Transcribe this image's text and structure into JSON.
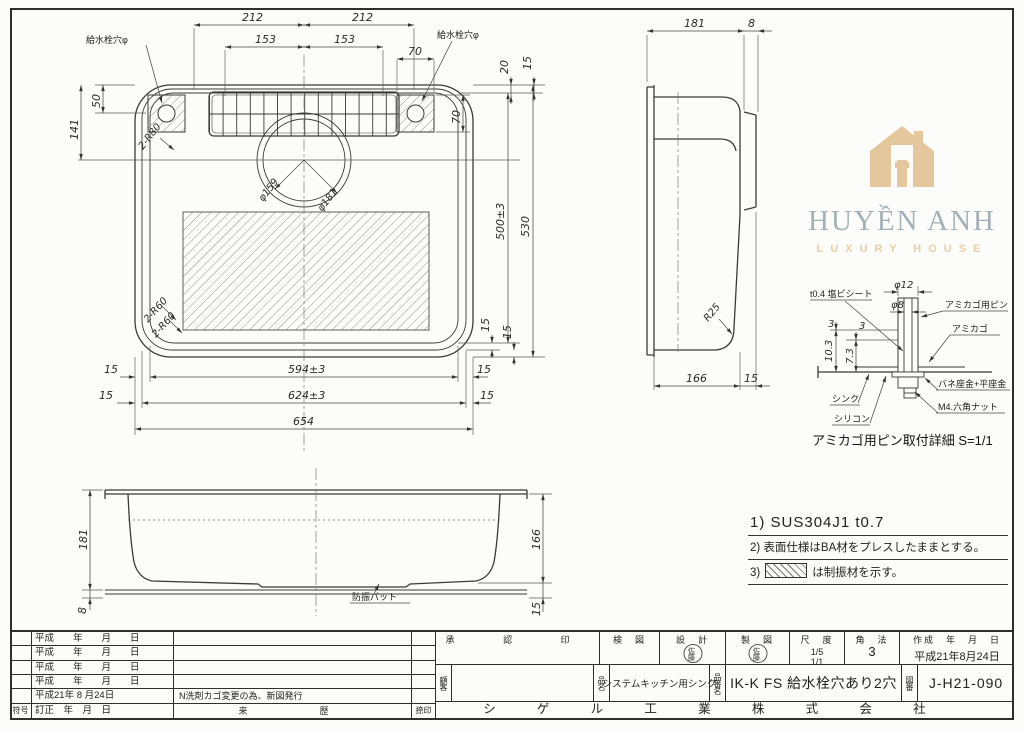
{
  "logo": {
    "title": "HUYỀN ANH",
    "subtitle": "LUXURY HOUSE",
    "title_color": "#a3b1b8",
    "accent_color": "#e4c79c"
  },
  "top_view": {
    "dims": {
      "d212l": "212",
      "d212r": "212",
      "d153l": "153",
      "d153r": "153",
      "d70top": "70",
      "d20": "20",
      "d15tr": "15",
      "d50": "50",
      "d141": "141",
      "d70r": "70",
      "r80": "2-R80",
      "r60a": "2-R60",
      "r60b": "2-R60",
      "dia159": "φ159",
      "dia181": "φ181",
      "d500": "500±3",
      "d530": "530",
      "d594": "594±3",
      "d624": "624±3",
      "d654": "654",
      "d15": "15"
    },
    "labels": {
      "faucet_left": "給水栓穴φ",
      "faucet_right": "給水栓穴φ"
    }
  },
  "side_view": {
    "dims": {
      "d181": "181",
      "d8": "8",
      "r25": "R25",
      "d166": "166",
      "d15": "15"
    }
  },
  "front_view": {
    "dims": {
      "d181": "181",
      "d8": "8",
      "d166": "166",
      "d15": "15"
    },
    "labels": {
      "pad": "防振パット"
    }
  },
  "detail_view": {
    "dims": {
      "dia12": "φ12",
      "dia8": "φ8",
      "d103": "10.3",
      "d73": "7.3",
      "d3a": "3",
      "d3b": "3"
    },
    "labels": {
      "sheet": "t0.4 塩ビシート",
      "pin": "アミカゴ用ピン",
      "basket": "アミカゴ",
      "washer": "バネ座金+平座金",
      "nut": "M4.六角ナット",
      "sink": "シンク",
      "silicone": "シリコン"
    },
    "caption": "アミカゴ用ピン取付詳細 S=1/1"
  },
  "notes": {
    "n1": "1) SUS304J1 t0.7",
    "n2": "2) 表面仕様はBA材をプレスしたままとする。",
    "n3_prefix": "3)",
    "n3_text": "は制振材を示す。"
  },
  "title_block": {
    "revisions": [
      {
        "date": "平成　　年　　月　　日",
        "desc": ""
      },
      {
        "date": "平成　　年　　月　　日",
        "desc": ""
      },
      {
        "date": "平成　　年　　月　　日",
        "desc": ""
      },
      {
        "date": "平成　　年　　月　　日",
        "desc": ""
      },
      {
        "date": "平成21年 8 月24日",
        "desc": "N洗剤カゴ変更の為、新図発行"
      }
    ],
    "header": {
      "sym": "符号",
      "date": "訂正　年　月　日",
      "history": "来　　歴",
      "stamp": "捺印"
    },
    "approval_label": "承　認　印",
    "check_label": "検　図",
    "design_label": "設　計",
    "draft_label": "製　図",
    "design_stamp": "佐藤",
    "draft_stamp": "佐藤",
    "scale_label": "尺　度",
    "scale_v1": "1/5",
    "scale_v2": "1/1",
    "method_label": "角　法",
    "method_value": "3",
    "created_label": "作成　年　月　日",
    "created_value": "平成21年8月24日",
    "customer_label": "顧客",
    "product_label": "品名",
    "product_value": "システムキッチン用シンク",
    "partno_label": "品番名",
    "partno_value": "IK-K FS 給水栓穴あり2穴",
    "dwgno_label": "図番",
    "dwgno_value": "J-H21-090",
    "company": "シゲル工業株式会社"
  }
}
